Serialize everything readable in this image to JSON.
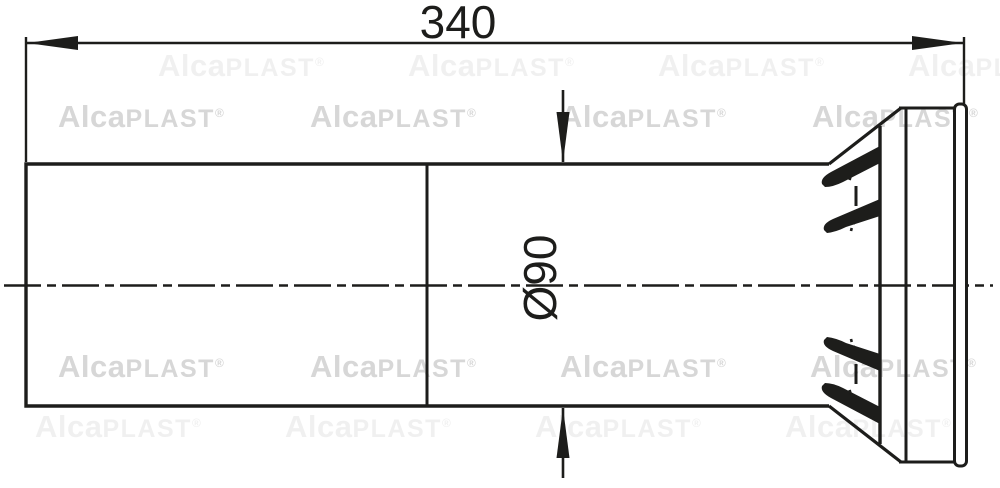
{
  "product_drawing": {
    "type": "technical-drawing",
    "subject": "pipe-connector-side-view"
  },
  "dimensions": {
    "length": "340",
    "diameter": "Ø90"
  },
  "line_color": "#1d1d1b",
  "background_color": "#ffffff",
  "watermark": {
    "text_bold": "Alca",
    "text_regular": "PLAST",
    "registered_mark": "®",
    "color": "#d7d7d7",
    "rows": [
      {
        "y": 99,
        "opacity": 1.0,
        "xs": [
          58,
          310,
          560,
          812
        ]
      },
      {
        "y": 349,
        "opacity": 1.0,
        "xs": [
          58,
          310,
          560,
          810
        ]
      },
      {
        "y": 48,
        "opacity": 0.35,
        "xs": [
          158,
          408,
          658,
          908
        ]
      },
      {
        "y": 409,
        "opacity": 0.35,
        "xs": [
          35,
          285,
          535,
          785
        ]
      }
    ]
  }
}
